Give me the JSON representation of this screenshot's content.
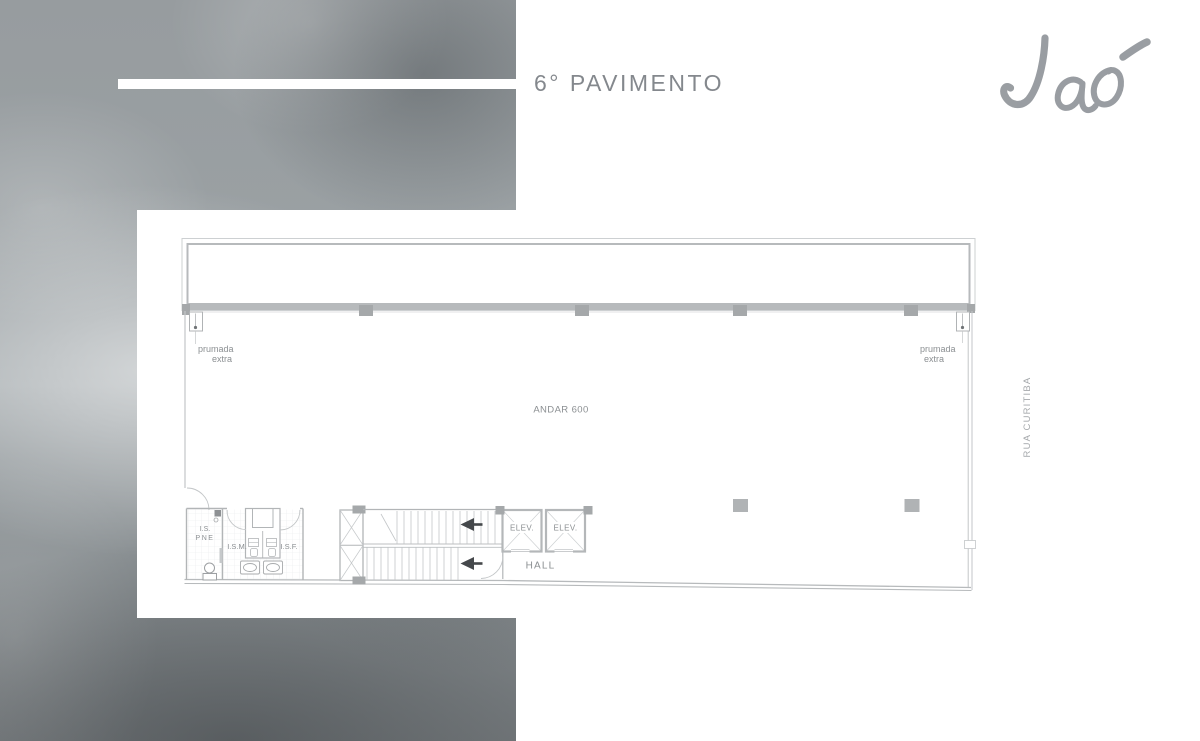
{
  "header": {
    "title": "6° PAVIMENTO"
  },
  "brand": {
    "logo_text": "Jaó"
  },
  "street": {
    "label": "RUA CURITIBA"
  },
  "plan": {
    "area_label": "ANDAR 600",
    "left_shaft": {
      "line1": "prumada",
      "line2": "extra"
    },
    "right_shaft": {
      "line1": "prumada",
      "line2": "extra"
    },
    "wc_accessible": {
      "line1": "I.S.",
      "line2": "PNE"
    },
    "wc_male": "I.S.M.",
    "wc_female": "I.S.F.",
    "elevator_1": "ELEV.",
    "elevator_2": "ELEV.",
    "hall": "HALL"
  },
  "colors": {
    "wall": "#b7babc",
    "line_light": "#c9cccd",
    "column": "#a5a8aa",
    "plan_text": "#8b8f92",
    "title_text": "#84888d",
    "logo": "#8f9398",
    "street_text": "#a6a9ac",
    "arrow": "#45484b"
  }
}
